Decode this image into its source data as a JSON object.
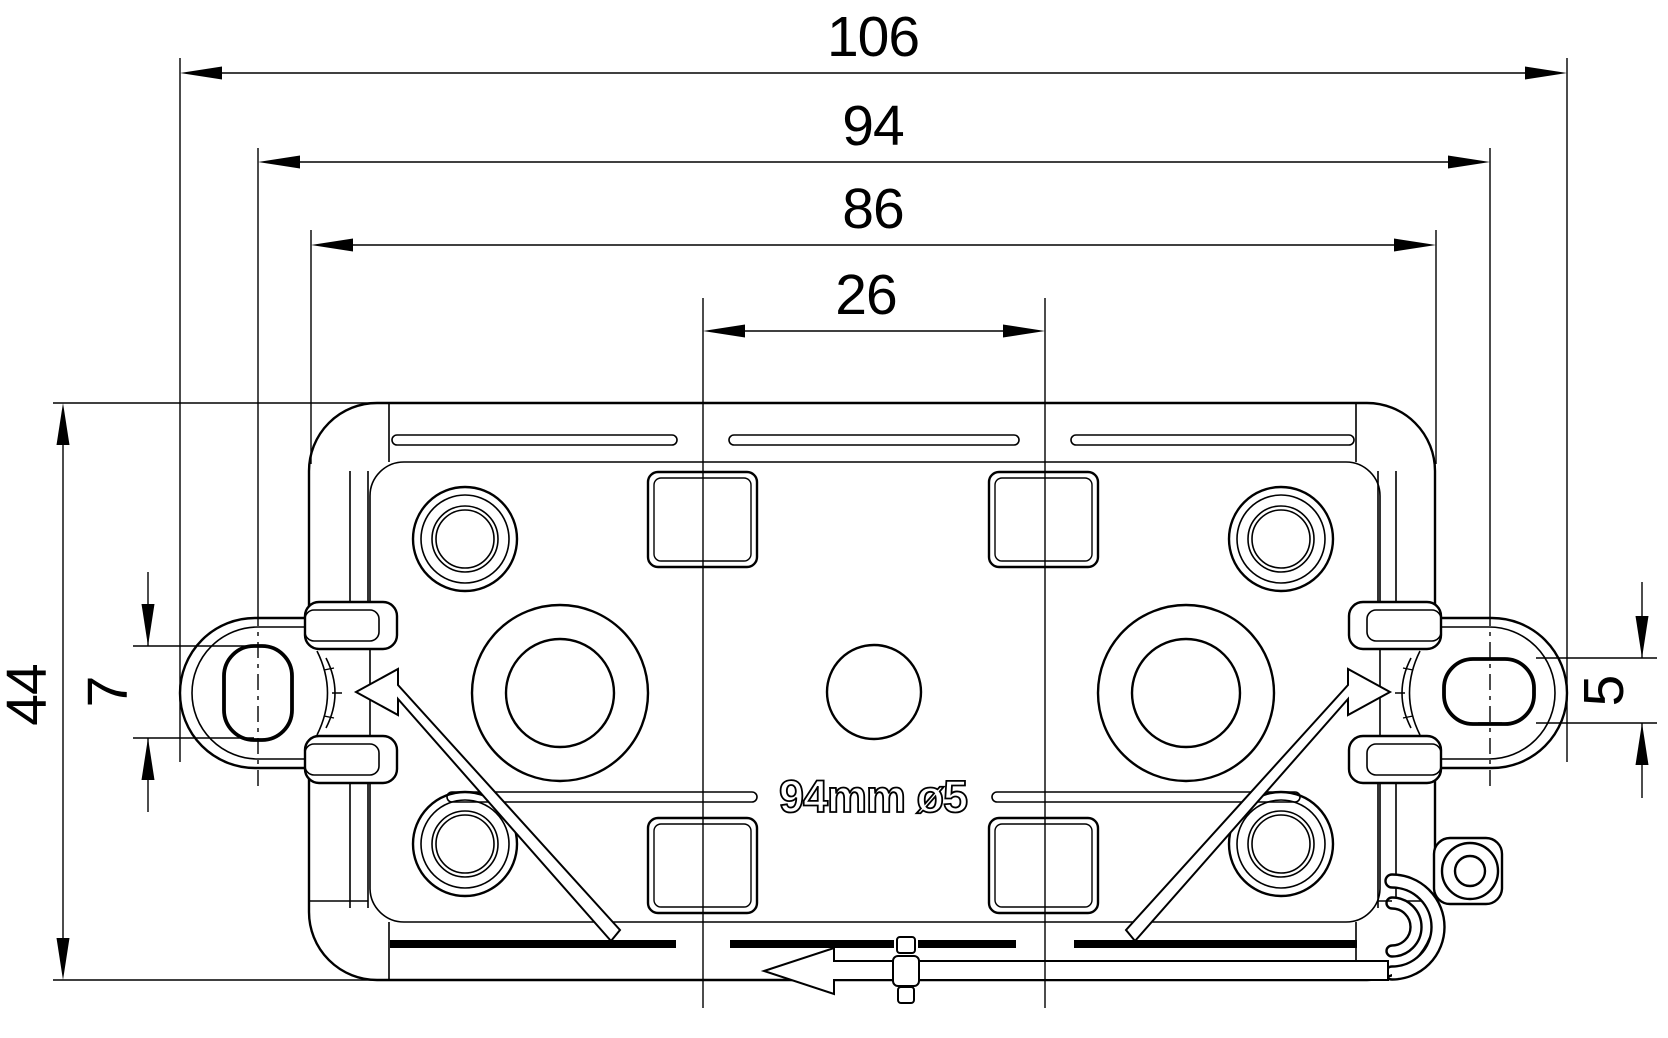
{
  "title": "Junction box enclosure — dimensioned technical drawing (rear view)",
  "colors": {
    "line": "#000000",
    "background": "#ffffff"
  },
  "dimensions": {
    "overall_width": "106",
    "mounting_hole_spacing": "94",
    "body_width": "86",
    "knockout_spacing": "26",
    "body_height": "44",
    "left_slot_height": "7",
    "right_slot_height": "5"
  },
  "annotation": {
    "mounting_note": "94mm ø5"
  }
}
